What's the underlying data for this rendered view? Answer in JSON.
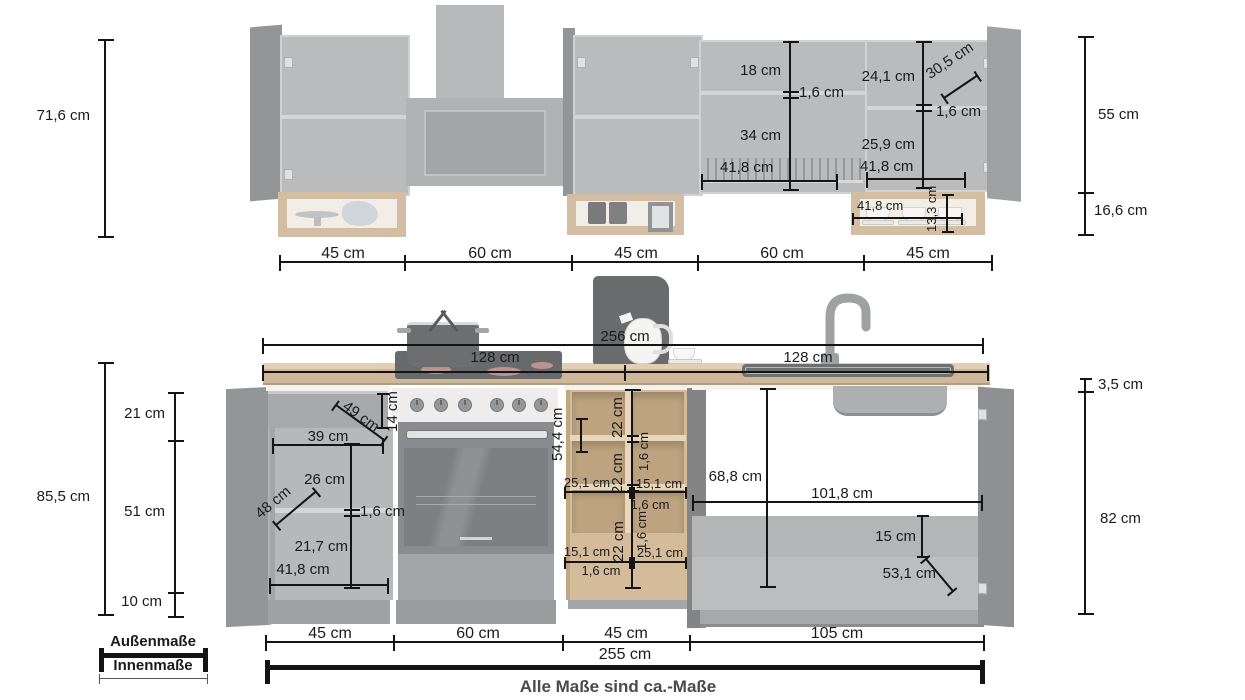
{
  "caption": "Alle Maße sind ca.-Maße",
  "legend": {
    "outer_label": "Außenmaße",
    "inner_label": "Innenmaße"
  },
  "upper_row": {
    "total_height": "71,6 cm",
    "cabinet_height": "55 cm",
    "shelf_height": "16,6 cm",
    "segments": [
      "45 cm",
      "60 cm",
      "45 cm",
      "60 cm",
      "45 cm"
    ],
    "dish_cabinet": {
      "top_compartment": "18 cm",
      "shelf_thickness": "1,6 cm",
      "bottom_compartment": "34 cm",
      "inner_width": "41,8 cm"
    },
    "right_cabinet": {
      "top_compartment": "24,1 cm",
      "door_width": "30,5 cm",
      "shelf_thickness": "1,6 cm",
      "bottom_compartment": "25,9 cm",
      "inner_width": "41,8 cm"
    },
    "cup_shelf": {
      "inner_width": "41,8 cm",
      "inner_height": "13,3 cm"
    }
  },
  "worktop": {
    "total_width": "256 cm",
    "left_width": "128 cm",
    "right_width": "128 cm"
  },
  "lower_row": {
    "total_height": "85,5 cm",
    "inner_heights": [
      "21 cm",
      "51 cm",
      "10 cm"
    ],
    "worktop_thickness": "3,5 cm",
    "carcass_height": "82 cm",
    "base_cabinet": {
      "drawer_depth": "49 cm",
      "drawer_height": "14 cm",
      "drawer_inner_width": "39 cm",
      "top_compartment": "26 cm",
      "door_width": "48 cm",
      "shelf_thickness": "1,6 cm",
      "bottom_compartment": "21,7 cm",
      "inner_width": "41,8 cm"
    },
    "open_shelf": {
      "inner_height": "54,4 cm",
      "compartment_1": "22 cm",
      "divider_1": "1,6 cm",
      "compartment_2": "22 cm",
      "divider_2": "1,6 cm",
      "compartment_3": "22 cm",
      "top_left_width": "25,1 cm",
      "top_right_width": "15,1 cm",
      "top_divider": "1,6 cm",
      "bottom_left_width": "15,1 cm",
      "bottom_right_width": "25,1 cm",
      "bottom_divider": "1,6 cm"
    },
    "sink_cabinet": {
      "inner_height": "68,8 cm",
      "inner_width": "101,8 cm",
      "plinth_height": "15 cm",
      "door_width": "53,1 cm"
    },
    "segments": [
      "45 cm",
      "60 cm",
      "45 cm",
      "105 cm"
    ],
    "total_width": "255 cm"
  }
}
